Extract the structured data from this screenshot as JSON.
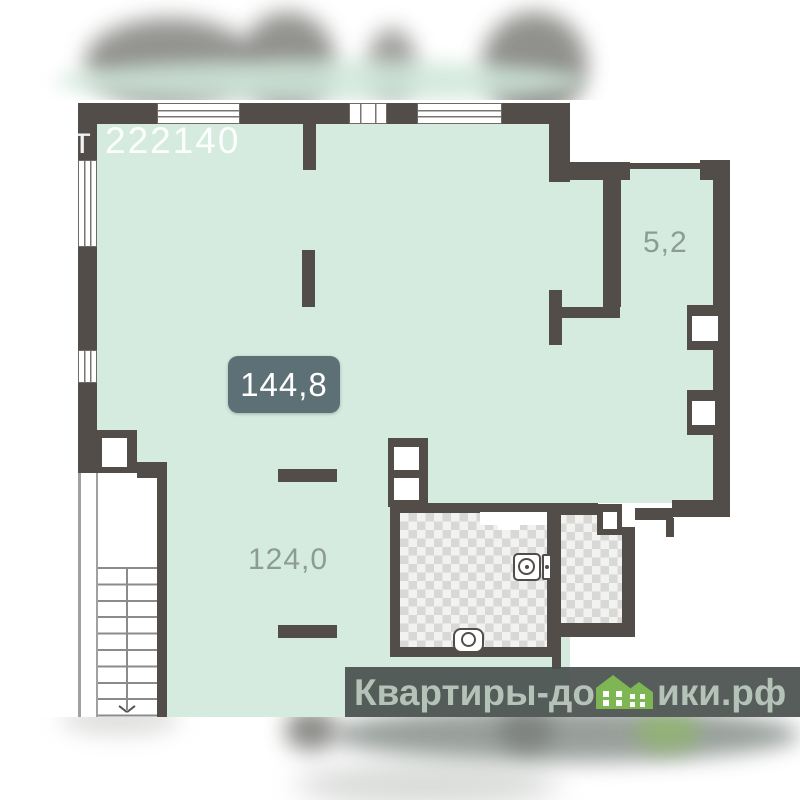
{
  "plan": {
    "price_text": "от 222140",
    "total_area": "144,8",
    "loggia_area": "5,2",
    "main_area": "124,0"
  },
  "watermark": {
    "left": "Квартиры-до",
    "right": "ики.рф",
    "full_site_name": "Квартиры-домики.рф"
  },
  "icons": {
    "houses": "green-houses-icon",
    "stair_arrow": "stair-direction-arrow",
    "washing_machine": "washing-machine-icon",
    "toilet": "toilet-icon"
  },
  "colors": {
    "floor_green": "#d5ebdf",
    "wall_dark": "#524d48",
    "badge_bg": "#5d7076",
    "badge_text": "#ffffff",
    "room_label_text": "#8d9a96",
    "watermark_bar_bg": "rgba(72,79,76,0.92)",
    "watermark_text": "#b4c2b8",
    "house_green": "#7db652",
    "tile_gray": "#d8d8d6",
    "price_text": "rgba(255,255,255,0.93)"
  }
}
